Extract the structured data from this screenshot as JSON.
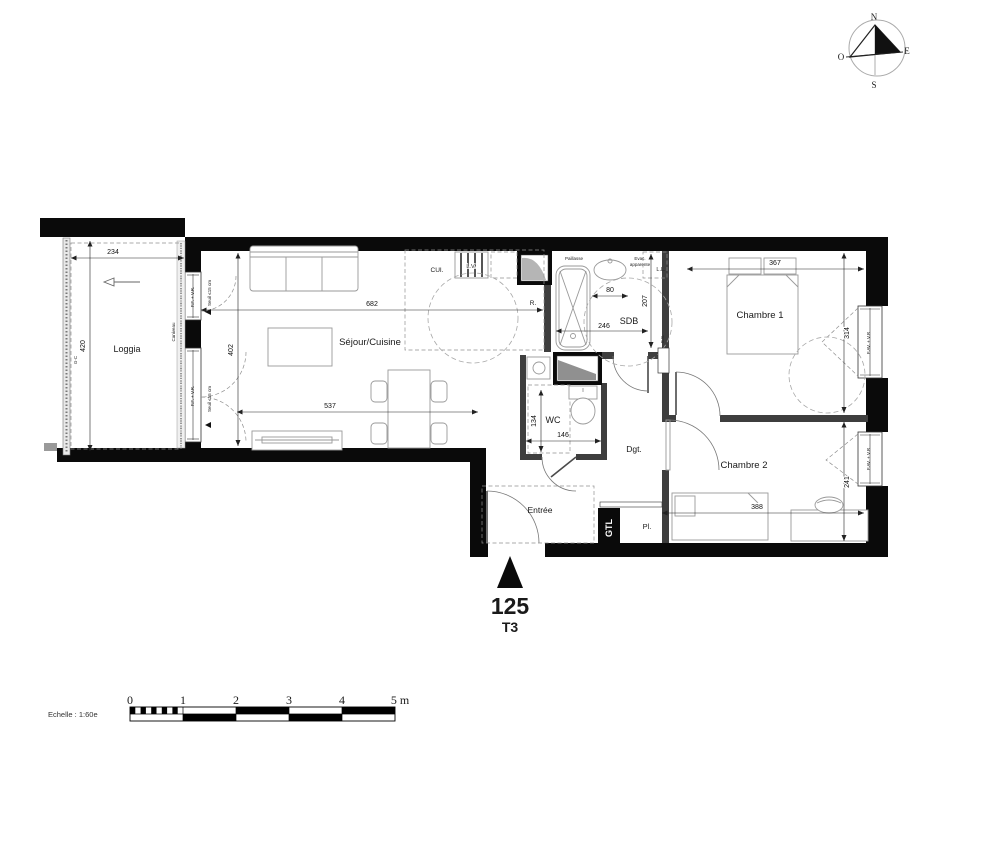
{
  "plan": {
    "unit": {
      "number": "125",
      "type": "T3"
    },
    "rooms": {
      "loggia": "Loggia",
      "sejour": "Séjour/Cuisine",
      "cuisine": "CUI.",
      "sdb": "SDB",
      "wc": "WC",
      "degagement": "Dgt.",
      "entree": "Entrée",
      "chambre1": "Chambre 1",
      "chambre2": "Chambre 2",
      "placard": "Pl.",
      "gtl": "GTL"
    },
    "equipment": {
      "lave_vaisselle": "L.V.",
      "refrigerateur": "R.",
      "lave_linge": "L.L.",
      "paillasse": "Paillasse",
      "evac_line1": "Evac.",
      "evac_line2": "apparente",
      "caniveau": "Caniveau",
      "garde_corps": "G-C",
      "seche_serviettes": "S.S."
    },
    "windows": {
      "pf_vr": "P.F. + V.R.",
      "fav_vr": "F.AV. + V.R",
      "seuil": "Seuil ≤15 cm"
    },
    "dimensions": {
      "loggia_w": "234",
      "loggia_h": "420",
      "sejour_w": "682",
      "sejour_h": "402",
      "sejour_w2": "537",
      "sdb_niche": "80",
      "sdb_h": "207",
      "sdb_w": "246",
      "wc_h": "134",
      "wc_w": "146",
      "ch1_w": "367",
      "ch1_h": "314",
      "ch2_w": "388",
      "ch2_h": "241"
    }
  },
  "compass": {
    "n": "N",
    "s": "S",
    "e": "E",
    "o": "O"
  },
  "scalebar": {
    "label": "Echelle : 1:60e",
    "t0": "0",
    "t1": "1",
    "t2": "2",
    "t3": "3",
    "t4": "4",
    "t5": "5 m"
  }
}
